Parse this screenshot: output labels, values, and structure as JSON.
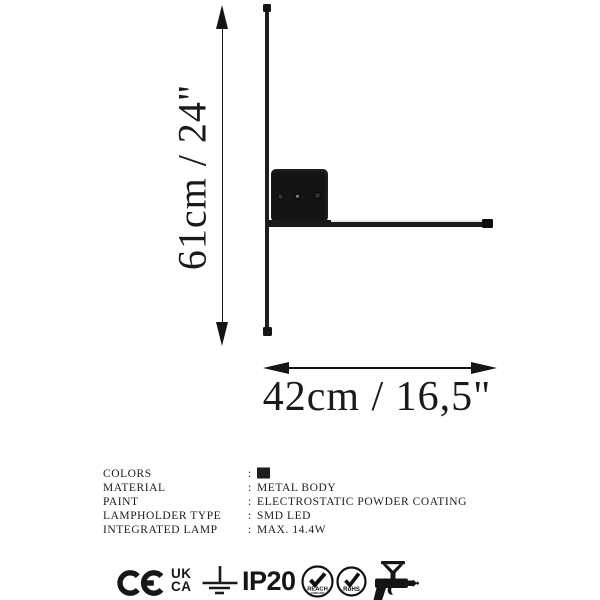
{
  "product": {
    "type_hint": "wall lamp technical drawing"
  },
  "dimensions": {
    "height_label": "61cm / 24\"",
    "width_label": "42cm / 16,5\""
  },
  "specs": {
    "colon": ":",
    "rows": [
      {
        "label": "COLORS",
        "value": ""
      },
      {
        "label": "MATERIAL",
        "value": "METAL BODY"
      },
      {
        "label": "PAINT",
        "value": "ELECTROSTATIC POWDER COATING"
      },
      {
        "label": "LAMPHOLDER TYPE",
        "value": "SMD LED"
      },
      {
        "label": "INTEGRATED LAMP",
        "value": "MAX. 14.4W"
      }
    ],
    "color_swatch_hex": "#1d1d1d"
  },
  "certifications": {
    "ukca_top": "UK",
    "ukca_bottom": "CA",
    "ip_rating": "IP20",
    "reach_label": "REACH",
    "reach_sub": "COMPLIANT",
    "rohs_label": "RoHS"
  },
  "icons": {
    "ce-mark-icon": "CE conformity arcs",
    "ukca-icon": "UK CA stacked letters",
    "earth-ground-icon": "vertical line over three shrinking bars",
    "reach-badge-icon": "circle with checkmark",
    "rohs-badge-icon": "circle with checkmark",
    "powder-coating-gun-icon": "spray gun silhouette"
  },
  "colors": {
    "drawing": "#1a1a1a",
    "background": "#ffffff"
  }
}
